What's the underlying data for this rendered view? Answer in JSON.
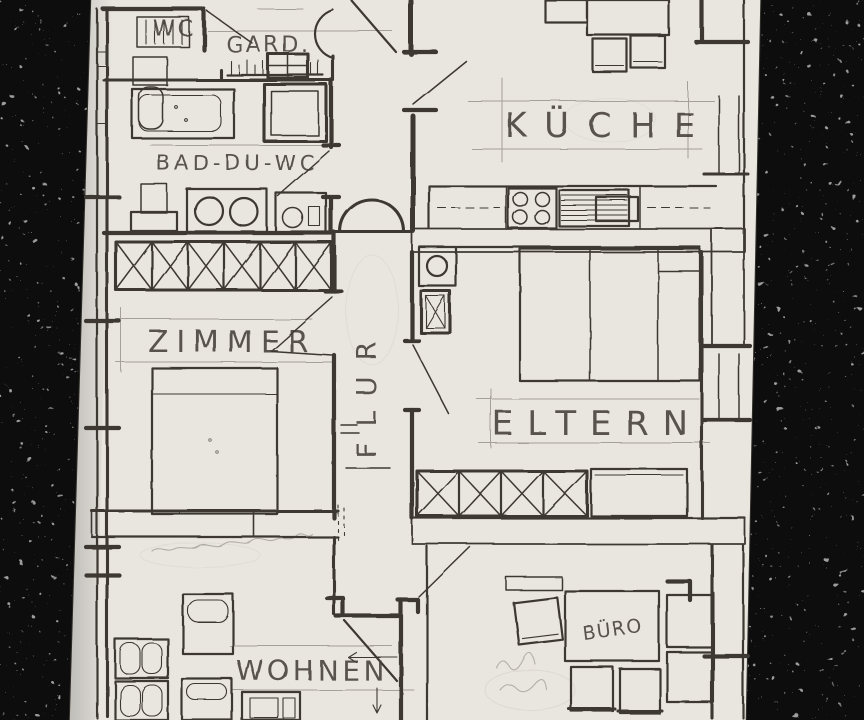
{
  "scene": {
    "description": "Hand-drawn pencil floor plan photographed on a dark speckled worktop",
    "colors": {
      "countertop": "#0c0c0c",
      "speckles": "#9b9b9b",
      "paper": "#e9e6e0",
      "pencil_dark": "#38322c",
      "pencil_light": "#8f887d"
    }
  },
  "floorplan": {
    "labels": {
      "wc": "WC",
      "gard": "GARD.",
      "bad": "BAD-DU-WC",
      "kueche": "KÜCHE",
      "zimmer": "ZIMMER",
      "flur": "FLUR",
      "eltern": "ELTERN",
      "wohnen": "WOHNEN",
      "buero": "BÜRO"
    }
  }
}
